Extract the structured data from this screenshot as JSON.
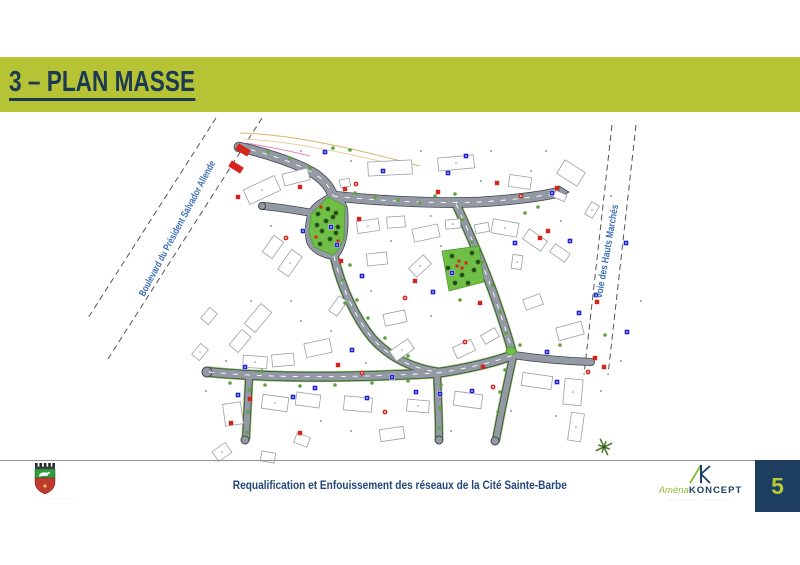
{
  "slide": {
    "title": "3 – PLAN MASSE",
    "title_bar_color": "#b5c334",
    "title_color": "#1c3a52",
    "page_number": "5",
    "page_square_color": "#1d3e5f",
    "page_number_color": "#b5cc3a"
  },
  "footer": {
    "project_title": "Requalification et Enfouissement des réseaux de la Cité Sainte-Barbe",
    "project_title_color": "#24477b",
    "coat_of_arms_icon": "city-coat-of-arms",
    "coat_caption": "····························",
    "logo_mark_icon": "ak-monogram",
    "logo_name_green": "Aména",
    "logo_name_dark": "KONCEPT",
    "logo_tagline": "·······························"
  },
  "map": {
    "boulevard_label": {
      "text": "Boulevard du Président Salvador Allende",
      "x": 180,
      "y": 230,
      "angle": -62,
      "length": 152
    },
    "voie_label": {
      "text": "Voie des Hauts Marchés",
      "x": 610,
      "y": 252,
      "angle": -80,
      "length": 95
    },
    "label_color": "#3f6eb5",
    "dashed_lines": [
      [
        216,
        118,
        88,
        318
      ],
      [
        262,
        118,
        106,
        362
      ],
      [
        612,
        125,
        584,
        375
      ],
      [
        636,
        125,
        608,
        375
      ]
    ],
    "roads": [
      {
        "d": "M239,147 C262,152 295,162 315,174 C326,182 330,188 333,196",
        "w": 9,
        "dash": true
      },
      {
        "d": "M333,196 C370,200 430,204 480,202 C510,200 540,197 559,192",
        "w": 9,
        "dash": true
      },
      {
        "d": "M312,213 C295,210 275,207 263,206",
        "w": 6.5
      },
      {
        "d": "M333,196 C322,202 314,207 312,213 C309,222 308,232 310,241 C313,249 322,254 334,256",
        "w": 6.5
      },
      {
        "d": "M333,196 C340,200 343,204 344,210 C345,224 344,238 340,247 C338,252 336,254 334,256",
        "w": 6.5
      },
      {
        "d": "M334,256 C342,290 356,318 372,338 C390,358 412,368 437,372",
        "w": 7,
        "dash": true,
        "green": true
      },
      {
        "d": "M209,372 C260,377 330,379 437,373",
        "w": 8,
        "dash": true,
        "green": true
      },
      {
        "d": "M249,379 C248,400 247,420 246,438",
        "w": 6,
        "green": true
      },
      {
        "d": "M437,373 C465,369 495,362 513,355",
        "w": 8,
        "dash": true,
        "green": true
      },
      {
        "d": "M456,204 C468,230 482,262 494,295 C502,318 509,340 513,355",
        "w": 7,
        "dash": true,
        "green": true
      },
      {
        "d": "M513,355 C540,359 565,361 591,362",
        "w": 6.5
      },
      {
        "d": "M513,357 C507,385 501,412 496,440",
        "w": 6,
        "green": true
      },
      {
        "d": "M437,373 C438,395 439,418 439,438",
        "w": 6,
        "green": true
      }
    ],
    "road_casing": "#40454c",
    "road_fill": "#939aa4",
    "road_green_edge": "#7cc24a",
    "culdesacs": [
      [
        207,
        372,
        5
      ],
      [
        245,
        440,
        4
      ],
      [
        495,
        441,
        4
      ],
      [
        439,
        440,
        4
      ],
      [
        262,
        206,
        3.5
      ]
    ],
    "road_tip": "559,186 569,192 559,198",
    "junction_green": [
      511,
      351
    ],
    "parks": [
      {
        "points": "328,197 345,206 344,238 339,249 333,255 314,247 309,233 311,214"
      },
      {
        "points": "442,251 479,246 484,282 449,291"
      }
    ],
    "park_color": "#6fbe45",
    "park_trees": [
      [
        318,
        214
      ],
      [
        326,
        221
      ],
      [
        333,
        217
      ],
      [
        338,
        227
      ],
      [
        322,
        231
      ],
      [
        330,
        239
      ],
      [
        336,
        233
      ],
      [
        317,
        225
      ],
      [
        328,
        209
      ],
      [
        336,
        213
      ],
      [
        320,
        244
      ],
      [
        452,
        256
      ],
      [
        472,
        253
      ],
      [
        448,
        268
      ],
      [
        474,
        270
      ],
      [
        455,
        283
      ],
      [
        468,
        283
      ],
      [
        462,
        275
      ],
      [
        478,
        262
      ]
    ],
    "park_red": [
      [
        321,
        207
      ],
      [
        338,
        241
      ],
      [
        316,
        237
      ],
      [
        459,
        261
      ],
      [
        466,
        263
      ],
      [
        462,
        268
      ],
      [
        457,
        266
      ]
    ],
    "street_trees": [
      [
        333,
        148
      ],
      [
        350,
        150
      ],
      [
        525,
        213
      ],
      [
        538,
        207
      ],
      [
        460,
        300
      ],
      [
        345,
        303
      ],
      [
        262,
        371
      ],
      [
        605,
        335
      ],
      [
        560,
        345
      ],
      [
        520,
        345
      ],
      [
        420,
        203
      ],
      [
        398,
        200
      ],
      [
        375,
        197
      ],
      [
        355,
        193
      ],
      [
        462,
        220
      ],
      [
        472,
        242
      ],
      [
        482,
        262
      ],
      [
        492,
        285
      ],
      [
        500,
        312
      ],
      [
        506,
        333
      ],
      [
        230,
        383
      ],
      [
        265,
        385
      ],
      [
        300,
        386
      ],
      [
        335,
        385
      ],
      [
        372,
        383
      ],
      [
        408,
        381
      ],
      [
        350,
        265
      ],
      [
        342,
        280
      ],
      [
        357,
        300
      ],
      [
        368,
        318
      ],
      [
        385,
        338
      ],
      [
        408,
        356
      ],
      [
        505,
        370
      ],
      [
        500,
        392
      ],
      [
        498,
        412
      ],
      [
        441,
        385
      ],
      [
        440,
        408
      ],
      [
        439,
        428
      ],
      [
        250,
        390
      ],
      [
        248,
        412
      ],
      [
        247,
        432
      ],
      [
        435,
        196
      ],
      [
        455,
        194
      ],
      [
        310,
        168
      ],
      [
        290,
        158
      ],
      [
        268,
        152
      ]
    ],
    "buildings": [
      [
        262,
        190,
        34,
        16,
        -25
      ],
      [
        296,
        177,
        26,
        12,
        -14
      ],
      [
        390,
        168,
        44,
        14,
        -3
      ],
      [
        456,
        163,
        36,
        13,
        -5
      ],
      [
        520,
        182,
        22,
        12,
        8
      ],
      [
        571,
        173,
        24,
        16,
        32
      ],
      [
        592,
        210,
        9,
        14,
        30
      ],
      [
        560,
        196,
        12,
        7,
        25
      ],
      [
        345,
        183,
        10,
        8,
        -12
      ],
      [
        368,
        226,
        22,
        12,
        -8
      ],
      [
        396,
        222,
        18,
        11,
        -4
      ],
      [
        426,
        233,
        26,
        13,
        -12
      ],
      [
        453,
        224,
        15,
        9,
        -5
      ],
      [
        482,
        228,
        14,
        9,
        -10
      ],
      [
        377,
        259,
        20,
        12,
        -6
      ],
      [
        420,
        266,
        20,
        12,
        -42
      ],
      [
        395,
        318,
        22,
        12,
        -12
      ],
      [
        338,
        306,
        18,
        10,
        -55
      ],
      [
        290,
        263,
        24,
        13,
        -55
      ],
      [
        273,
        247,
        20,
        12,
        -55
      ],
      [
        209,
        316,
        14,
        10,
        -50
      ],
      [
        200,
        352,
        14,
        10,
        -50
      ],
      [
        258,
        318,
        26,
        14,
        -50
      ],
      [
        240,
        341,
        20,
        12,
        -50
      ],
      [
        505,
        228,
        26,
        14,
        10
      ],
      [
        535,
        240,
        22,
        12,
        35
      ],
      [
        560,
        253,
        18,
        10,
        35
      ],
      [
        517,
        262,
        10,
        14,
        8
      ],
      [
        533,
        302,
        18,
        11,
        -20
      ],
      [
        570,
        331,
        26,
        13,
        -15
      ],
      [
        255,
        362,
        24,
        12,
        4
      ],
      [
        283,
        360,
        22,
        12,
        -5
      ],
      [
        318,
        348,
        26,
        14,
        -12
      ],
      [
        402,
        350,
        22,
        12,
        -35
      ],
      [
        464,
        349,
        20,
        12,
        -25
      ],
      [
        490,
        336,
        16,
        10,
        -30
      ],
      [
        275,
        403,
        26,
        14,
        8
      ],
      [
        308,
        400,
        24,
        13,
        8
      ],
      [
        233,
        414,
        18,
        22,
        -8
      ],
      [
        222,
        452,
        16,
        12,
        -35
      ],
      [
        268,
        457,
        14,
        10,
        10
      ],
      [
        358,
        404,
        28,
        14,
        5
      ],
      [
        418,
        406,
        22,
        12,
        5
      ],
      [
        468,
        400,
        28,
        14,
        8
      ],
      [
        537,
        381,
        30,
        13,
        8
      ],
      [
        573,
        392,
        18,
        26,
        5
      ],
      [
        392,
        434,
        24,
        12,
        -8
      ],
      [
        302,
        440,
        14,
        10,
        20
      ],
      [
        576,
        427,
        13,
        28,
        8
      ]
    ],
    "red_markers": [
      [
        300,
        187
      ],
      [
        345,
        189
      ],
      [
        356,
        184
      ],
      [
        438,
        192
      ],
      [
        497,
        183
      ],
      [
        521,
        196
      ],
      [
        238,
        197
      ],
      [
        359,
        219
      ],
      [
        286,
        238
      ],
      [
        341,
        261
      ],
      [
        415,
        281
      ],
      [
        405,
        298
      ],
      [
        540,
        238
      ],
      [
        548,
        231
      ],
      [
        362,
        373
      ],
      [
        338,
        365
      ],
      [
        483,
        367
      ],
      [
        493,
        387
      ],
      [
        595,
        358
      ],
      [
        604,
        367
      ],
      [
        588,
        372
      ],
      [
        250,
        399
      ],
      [
        231,
        423
      ],
      [
        385,
        412
      ],
      [
        300,
        433
      ],
      [
        480,
        303
      ],
      [
        465,
        342
      ],
      [
        597,
        302
      ],
      [
        557,
        188
      ]
    ],
    "blue_markers": [
      [
        325,
        152
      ],
      [
        383,
        171
      ],
      [
        448,
        173
      ],
      [
        466,
        156
      ],
      [
        303,
        231
      ],
      [
        331,
        227
      ],
      [
        337,
        245
      ],
      [
        362,
        276
      ],
      [
        433,
        292
      ],
      [
        452,
        273
      ],
      [
        515,
        243
      ],
      [
        570,
        241
      ],
      [
        626,
        243
      ],
      [
        552,
        193
      ],
      [
        579,
        313
      ],
      [
        352,
        350
      ],
      [
        392,
        377
      ],
      [
        367,
        398
      ],
      [
        440,
        394
      ],
      [
        472,
        391
      ],
      [
        547,
        352
      ],
      [
        557,
        382
      ],
      [
        596,
        295
      ],
      [
        627,
        332
      ],
      [
        293,
        397
      ],
      [
        245,
        367
      ],
      [
        238,
        395
      ],
      [
        416,
        392
      ],
      [
        315,
        388
      ]
    ],
    "specks": [
      [
        350,
        160
      ],
      [
        420,
        150
      ],
      [
        490,
        150
      ],
      [
        545,
        150
      ],
      [
        300,
        150
      ],
      [
        430,
        215
      ],
      [
        390,
        240
      ],
      [
        440,
        245
      ],
      [
        370,
        290
      ],
      [
        330,
        330
      ],
      [
        300,
        320
      ],
      [
        250,
        300
      ],
      [
        225,
        360
      ],
      [
        205,
        390
      ],
      [
        320,
        420
      ],
      [
        350,
        430
      ],
      [
        450,
        430
      ],
      [
        510,
        410
      ],
      [
        555,
        415
      ],
      [
        600,
        390
      ],
      [
        620,
        360
      ],
      [
        640,
        300
      ],
      [
        560,
        220
      ],
      [
        480,
        180
      ],
      [
        270,
        225
      ],
      [
        290,
        300
      ],
      [
        430,
        315
      ],
      [
        365,
        362
      ],
      [
        530,
        170
      ],
      [
        610,
        195
      ]
    ],
    "entrance_blocks": [
      [
        243,
        150,
        14,
        7,
        32
      ],
      [
        236,
        167,
        14,
        7,
        32
      ]
    ],
    "survey_lines": [
      {
        "d": "M240,133 C280,134 330,142 420,166",
        "c": "#d4b96a"
      },
      {
        "d": "M243,139 C285,141 335,150 405,167",
        "c": "#e4d49b"
      },
      {
        "d": "M246,143 C270,147 290,151 310,156",
        "c": "#e586b0"
      }
    ],
    "star": [
      604,
      447
    ],
    "colors": {
      "red": "#d5241b",
      "blue": "#2023c8",
      "tree": "#2f5a1f",
      "bush": "#5da23c",
      "speck": "#aab0b6",
      "building_stroke": "#9aa0a6",
      "star": "#4c7a2e",
      "dash_line": "#555555"
    }
  }
}
